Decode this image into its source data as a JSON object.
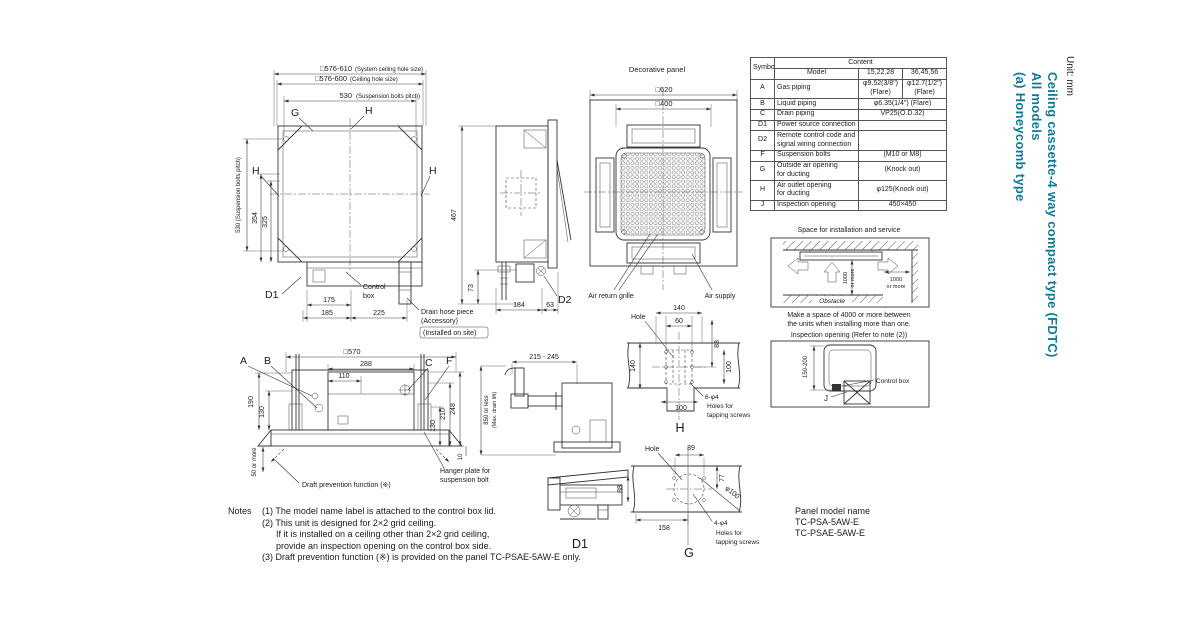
{
  "meta": {
    "unit_note": "Unit: mm"
  },
  "title": {
    "line1": "Ceiling cassette-4 way compact type (FDTC)",
    "line2": "All models",
    "line3": "(a) Honeycomb type",
    "accent_color": "#0e7a9b"
  },
  "plan": {
    "sys_hole": "□576-610",
    "sys_hole_note": "(System ceiling hole size)",
    "ceil_hole": "□576-600",
    "ceil_hole_note": "(Ceiling hole size)",
    "pitch": "530",
    "pitch_note": "(Suspension bolts pitch)",
    "pitch_v": "530 (Suspension bolts pitch)",
    "d354": "354",
    "d325": "325",
    "g": "G",
    "h_top": "H",
    "h_left": "H",
    "h_right": "H",
    "d1": "D1",
    "d175": "175",
    "d185": "185",
    "d225": "225",
    "control_1": "Control",
    "control_2": "box",
    "drain_1": "Drain hose piece",
    "drain_2": "(Accessory)",
    "drain_3": "(Installed on site)",
    "d467": "467",
    "d73": "73"
  },
  "side": {
    "d184": "184",
    "d63": "63",
    "d2": "D2"
  },
  "panel": {
    "title": "Decorative panel",
    "d620": "□620",
    "d400": "□400",
    "air_return": "Air return grille",
    "air_supply": "Air supply"
  },
  "table": {
    "symbol": "Symbol",
    "content": "Content",
    "model": "Model",
    "m1": "15,22,28",
    "m2": "36,45,56",
    "rows": [
      {
        "symbol": "A",
        "name": "Gas piping",
        "v1": "φ9.52(3/8\")\n(Flare)",
        "v2": "φ12.7(1/2\")\n(Flare)"
      },
      {
        "symbol": "B",
        "name": "Liquid piping",
        "v": "φ6.35(1/4\") (Flare)"
      },
      {
        "symbol": "C",
        "name": "Drain piping",
        "v": "VP25(O.D.32)"
      },
      {
        "symbol": "D1",
        "name": "Power source connection",
        "v": ""
      },
      {
        "symbol": "D2",
        "name": "Remote control code and\nsignal wiring connection",
        "v": ""
      },
      {
        "symbol": "F",
        "name": "Suspension bolts",
        "v": "(M10 or M8)"
      },
      {
        "symbol": "G",
        "name": "Outside air opening\nfor ducting",
        "v": "(Knock out)"
      },
      {
        "symbol": "H",
        "name": "Air outlet opening\nfor ducting",
        "v": "φ125(Knock out)"
      },
      {
        "symbol": "J",
        "name": "Inspection opening",
        "v": "450×450"
      }
    ]
  },
  "space": {
    "title": "Space for installation and service",
    "v1a": "1000",
    "v1b": "or more",
    "v2a": "1000",
    "v2b": "or more",
    "obstacle": "Obstacle",
    "cap1": "Make a space of 4000 or more between",
    "cap2": "the units when installing more than one."
  },
  "inspect": {
    "title": "Inspection opening (Refer to note (2))",
    "dim": "150-200",
    "control_box": "Control box",
    "j": "J"
  },
  "elev": {
    "d570": "□570",
    "d288": "288",
    "d110": "110",
    "a": "A",
    "b": "B",
    "c": "C",
    "f": "F",
    "d190": "190",
    "d130l": "130",
    "d50": "50 or more",
    "d248": "248",
    "d210": "210",
    "d130r": "130",
    "d10": "10",
    "draft": "Draft prevention function (※)",
    "hanger1": "Hanger plate for",
    "hanger2": "suspension bolt"
  },
  "drain": {
    "d215": "215 - 245",
    "d850a": "850 or less",
    "d850b": "(Max. drain lift)"
  },
  "hview": {
    "hole": "Hole",
    "d140t": "140",
    "d60": "60",
    "d88": "88",
    "d140l": "140",
    "d100r": "100",
    "d100b": "100",
    "screws1": "6-φ4",
    "screws2": "Holes for",
    "screws3": "tapping screws",
    "label": "H"
  },
  "gview": {
    "hole": "Hole",
    "d89": "89",
    "d77": "77",
    "d88": "88",
    "d100": "φ100",
    "d158": "158",
    "screws1": "4-φ4",
    "screws2": "Holes for",
    "screws3": "tapping screws",
    "label": "G"
  },
  "d1view": {
    "label": "D1"
  },
  "notes": {
    "label": "Notes",
    "l1": "(1) The model name label is attached to the control box lid.",
    "l2": "(2) This unit is designed for 2×2 grid ceiling.",
    "l3": "If it is installed on a ceiling other than 2×2 grid ceiling,",
    "l4": "provide an inspection opening on the control box side.",
    "l5": "(3) Draft prevention function (※) is provided on the panel TC-PSAE-5AW-E only."
  },
  "panel_model": {
    "title": "Panel model name",
    "m1": "TC-PSA-5AW-E",
    "m2": "TC-PSAE-5AW-E"
  }
}
